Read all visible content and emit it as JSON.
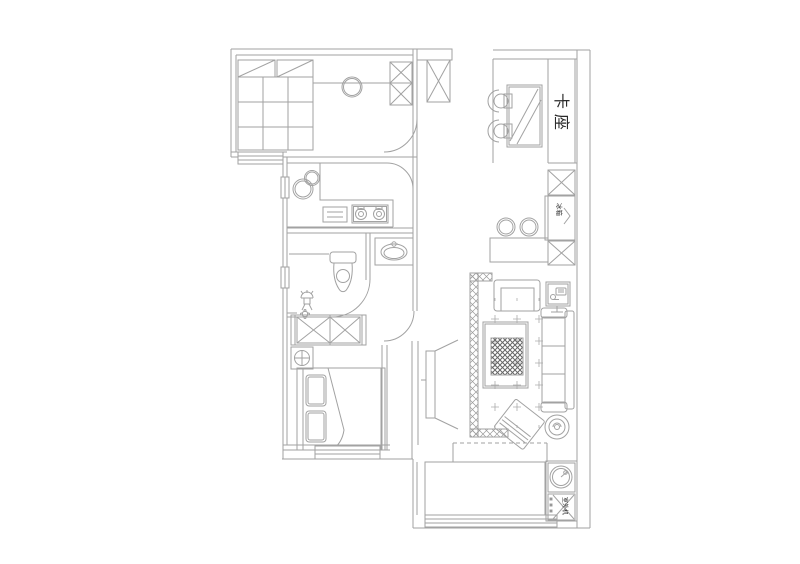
{
  "labels": {
    "booth_seat": "卡座",
    "fridge": "冰箱",
    "ac_outdoor_unit": "室外机"
  },
  "colors": {
    "background": "#ffffff",
    "line_light": "#a2a2a2",
    "line_dark": "#8c8c8c",
    "hatch_dark": "#666666",
    "text": "#2b2b2b"
  }
}
